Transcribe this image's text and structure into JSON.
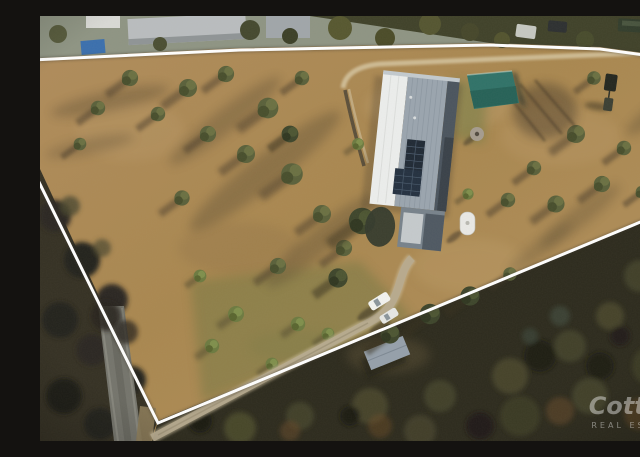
{
  "meta": {
    "asset_type": "aerial drone photograph",
    "subject": "rural acreage property for sale with white boundary outline overlay",
    "canvas": {
      "width": 640,
      "height": 425
    }
  },
  "watermark": {
    "brand": "Cotton",
    "tagline": "REAL ESTATE"
  },
  "boundary": {
    "style": "white surveyed boundary outline",
    "color": "#ffffff"
  },
  "scene": {
    "inside_property": [
      "long steel-roofed house with rooftop solar panels",
      "teal shade-covered pool enclosure",
      "white water tank / caravan",
      "small grey dome",
      "gravel driveway from road to house",
      "two parked white vehicles on driveway",
      "dark vehicle with trailer near top-right",
      "scattered gum trees casting long shadows on dry grass",
      "greener lawn strip along lower driveway"
    ],
    "outside_property": [
      "neighbouring sheds and grey-roofed buildings along top",
      "parked trucks and machinery top-right corner",
      "blue-roofed structure top-left",
      "bitumen road running down bottom-left",
      "dense dark bushland across bottom-right",
      "small grey shed in bushland clearing"
    ]
  },
  "colors": {
    "boundary_line": "#ffffff",
    "dry_grass": "#ae8b59",
    "green_lawn": "#6b7540",
    "tree_olive": "#59603a",
    "bushland_dark": "#2c2a1d",
    "roof_white": "#eceeed",
    "roof_grey": "#9aa5af",
    "roof_dark": "#4a545e",
    "solar_panel": "#1f2935",
    "pool_cover_teal": "#2f7268",
    "road_grey": "#74746c",
    "gravel": "#cdbf9f",
    "watermark_white": "#ffffff"
  }
}
